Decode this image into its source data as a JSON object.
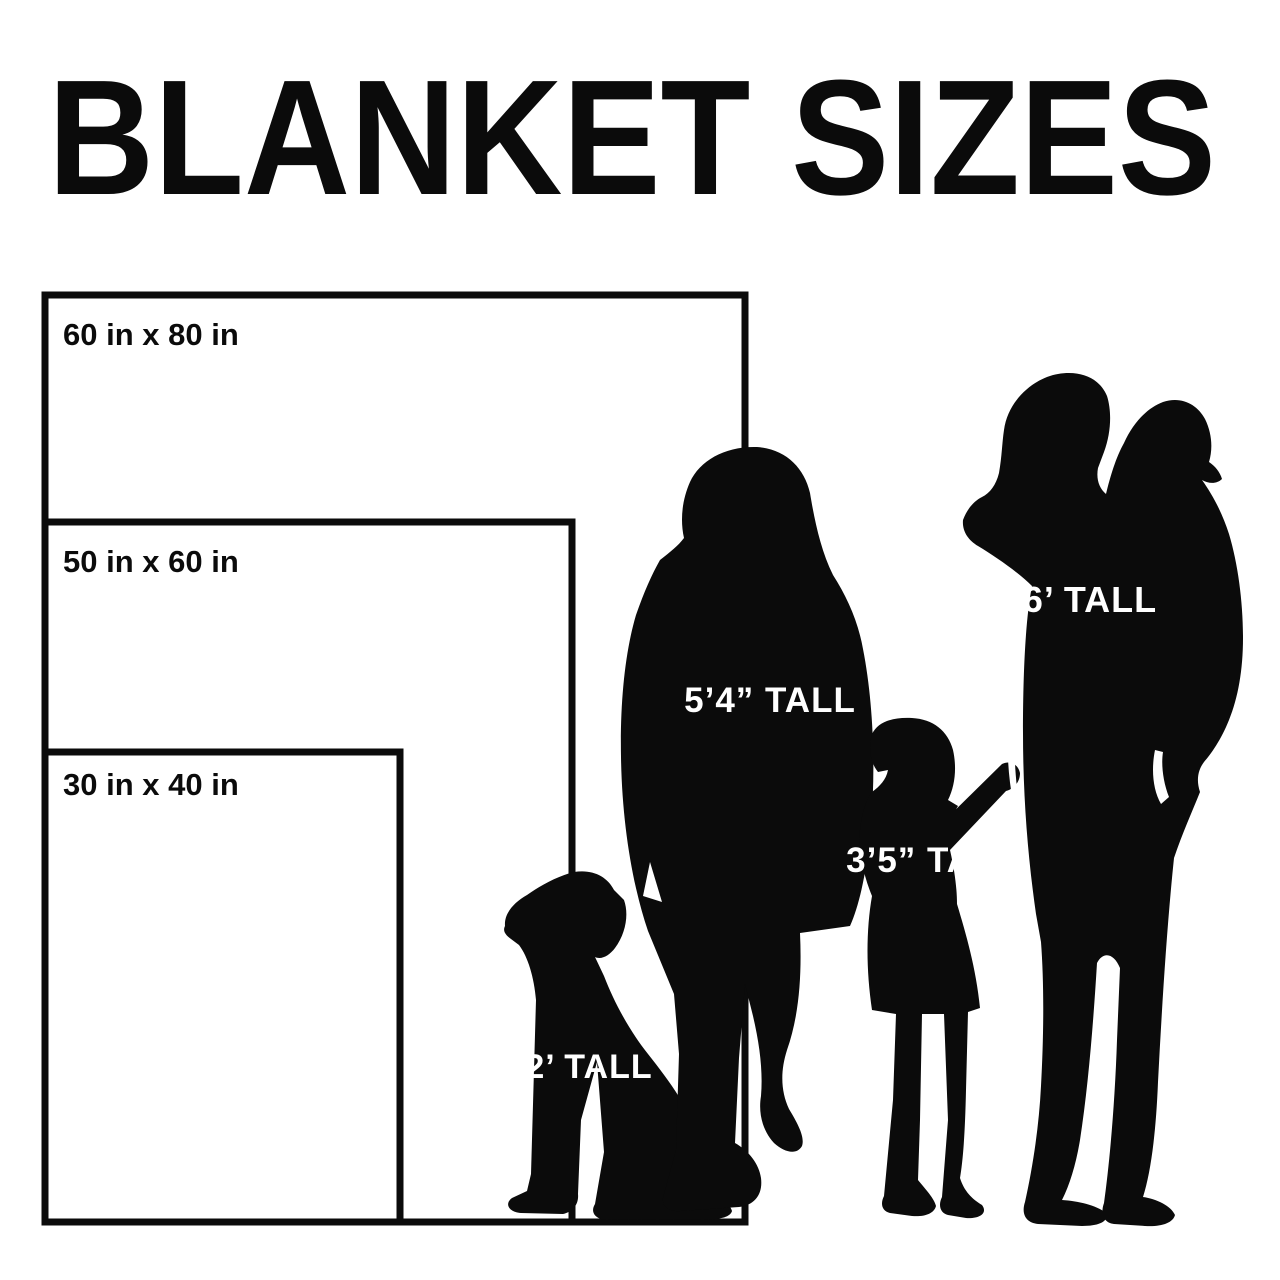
{
  "title": "BLANKET SIZES",
  "colors": {
    "ink": "#0b0b0b",
    "paper": "#ffffff",
    "figure_label_text": "#ffffff"
  },
  "blankets": [
    {
      "label": "60 in x 80 in",
      "width_in": 60,
      "height_in": 80
    },
    {
      "label": "50 in x 60 in",
      "width_in": 50,
      "height_in": 60
    },
    {
      "label": "30 in x 40 in",
      "width_in": 30,
      "height_in": 40
    }
  ],
  "figures": [
    {
      "name": "dog",
      "label": "2’ TALL"
    },
    {
      "name": "woman",
      "label": "5’4” TALL"
    },
    {
      "name": "child",
      "label": "3’5” TALL"
    },
    {
      "name": "man",
      "label": "6’ TALL"
    }
  ]
}
